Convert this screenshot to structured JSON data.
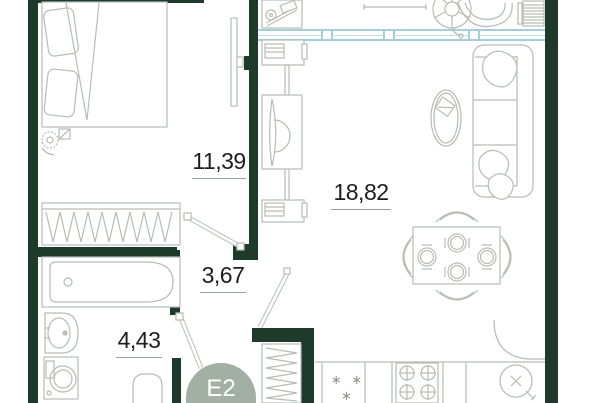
{
  "unit": {
    "badge": "E2"
  },
  "rooms": {
    "bedroom": {
      "area": "11,39"
    },
    "living": {
      "area": "18,82"
    },
    "hallway": {
      "area": "3,67"
    },
    "bathroom": {
      "area": "4,43"
    }
  },
  "kitchen": {
    "freezer_symbol": "∗ ∗ ∗"
  },
  "icons": [
    "double-bed",
    "pillow",
    "wardrobe-hangers",
    "tv",
    "bathtub",
    "sink",
    "washing-machine",
    "toilet",
    "sofa",
    "coffee-table",
    "laptop",
    "dining-table",
    "dining-chair",
    "stove",
    "kitchen-sink",
    "radiator",
    "plant",
    "door-leaf"
  ],
  "colors": {
    "wall": "#1e3a2a",
    "window_stroke": "#a7ced8",
    "window_fill": "#eff7f9",
    "furniture_stroke": "#b6bcb6",
    "unit_badge": "#a1b0a3",
    "label_text": "#1d1d1d"
  }
}
